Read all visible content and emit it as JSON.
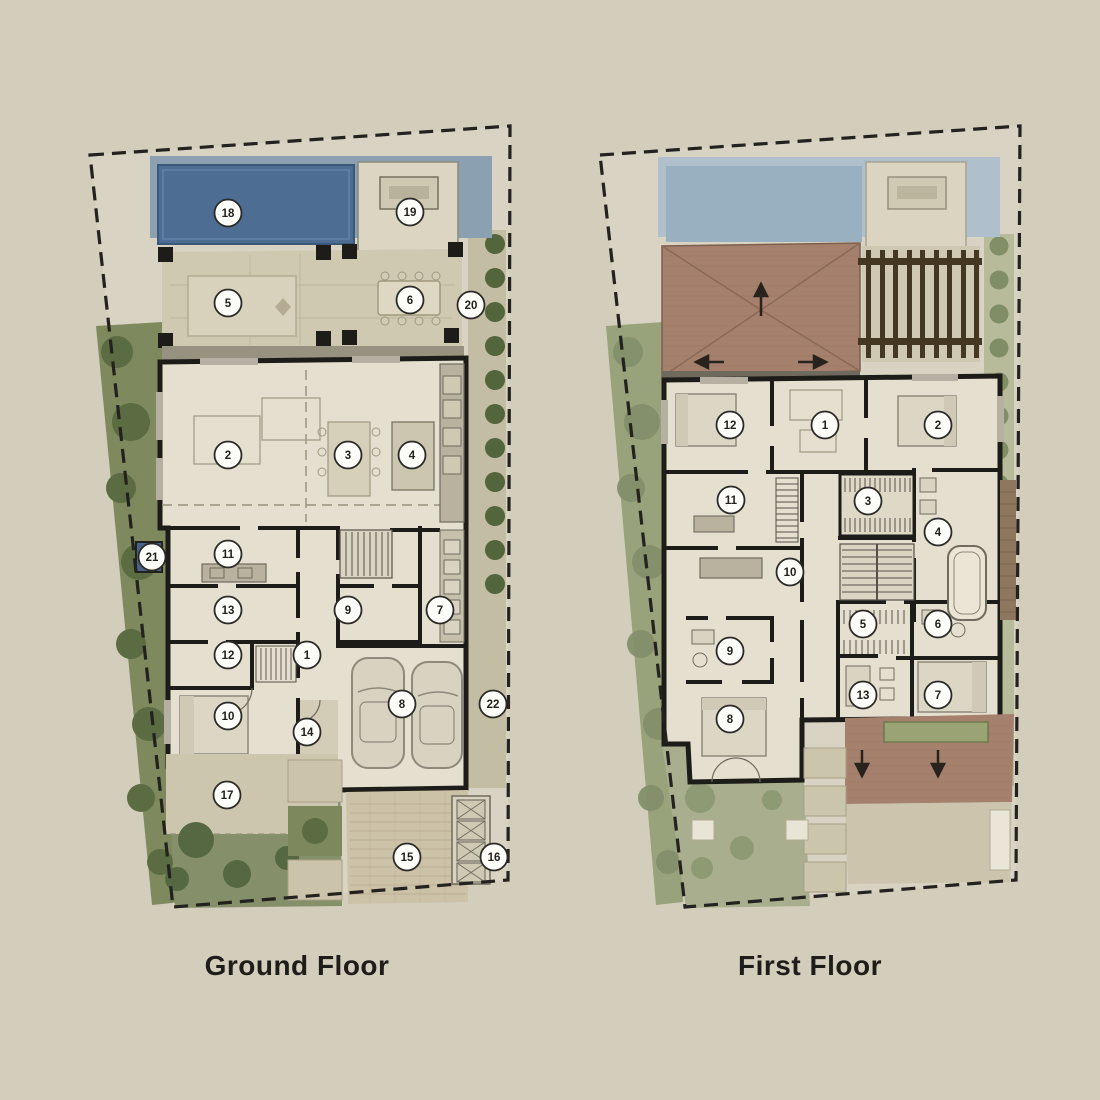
{
  "sheet": {
    "background": "#d3cdbc",
    "description": "Villa floor plan sheet with two keyed plans"
  },
  "colors": {
    "paper": "#d8d3c2",
    "boundary_dash": "#23221e",
    "wall": "#1d1c18",
    "room_floor": "#e4dfce",
    "terrace_stone": "#cfc9b2",
    "pool_water": "#4d6d93",
    "pool_deck": "#8ba1b2",
    "pool_faded": "#99b0c1",
    "grass": "#7e895e",
    "tree": "#5b6c42",
    "grass_faded": "#a8ae8e",
    "roof_tile": "#a5806c",
    "pergola_wood": "#453823",
    "planter_green": "#99a373",
    "marker_fill": "#fdfdfa",
    "marker_stroke": "#2b2a26",
    "title_text": "#1e1d19",
    "water_feature": "#47658b"
  },
  "ground_floor": {
    "title": "Ground Floor",
    "markers": [
      {
        "n": "1",
        "x": 307,
        "y": 655
      },
      {
        "n": "2",
        "x": 228,
        "y": 455
      },
      {
        "n": "3",
        "x": 348,
        "y": 455
      },
      {
        "n": "4",
        "x": 412,
        "y": 455
      },
      {
        "n": "5",
        "x": 228,
        "y": 303
      },
      {
        "n": "6",
        "x": 410,
        "y": 300
      },
      {
        "n": "7",
        "x": 440,
        "y": 610
      },
      {
        "n": "8",
        "x": 402,
        "y": 704
      },
      {
        "n": "9",
        "x": 348,
        "y": 610
      },
      {
        "n": "10",
        "x": 228,
        "y": 716
      },
      {
        "n": "11",
        "x": 228,
        "y": 554
      },
      {
        "n": "12",
        "x": 228,
        "y": 655
      },
      {
        "n": "13",
        "x": 228,
        "y": 610
      },
      {
        "n": "14",
        "x": 307,
        "y": 732
      },
      {
        "n": "15",
        "x": 407,
        "y": 857
      },
      {
        "n": "16",
        "x": 494,
        "y": 857
      },
      {
        "n": "17",
        "x": 227,
        "y": 795
      },
      {
        "n": "18",
        "x": 228,
        "y": 213
      },
      {
        "n": "19",
        "x": 410,
        "y": 212
      },
      {
        "n": "20",
        "x": 471,
        "y": 305
      },
      {
        "n": "21",
        "x": 152,
        "y": 557
      },
      {
        "n": "22",
        "x": 493,
        "y": 704
      }
    ]
  },
  "first_floor": {
    "title": "First Floor",
    "markers": [
      {
        "n": "1",
        "x": 825,
        "y": 425
      },
      {
        "n": "2",
        "x": 938,
        "y": 425
      },
      {
        "n": "3",
        "x": 868,
        "y": 501
      },
      {
        "n": "4",
        "x": 938,
        "y": 532
      },
      {
        "n": "5",
        "x": 863,
        "y": 624
      },
      {
        "n": "6",
        "x": 938,
        "y": 624
      },
      {
        "n": "7",
        "x": 938,
        "y": 695
      },
      {
        "n": "8",
        "x": 730,
        "y": 719
      },
      {
        "n": "9",
        "x": 730,
        "y": 651
      },
      {
        "n": "10",
        "x": 790,
        "y": 572
      },
      {
        "n": "11",
        "x": 731,
        "y": 500
      },
      {
        "n": "12",
        "x": 730,
        "y": 425
      },
      {
        "n": "13",
        "x": 863,
        "y": 695
      }
    ]
  }
}
